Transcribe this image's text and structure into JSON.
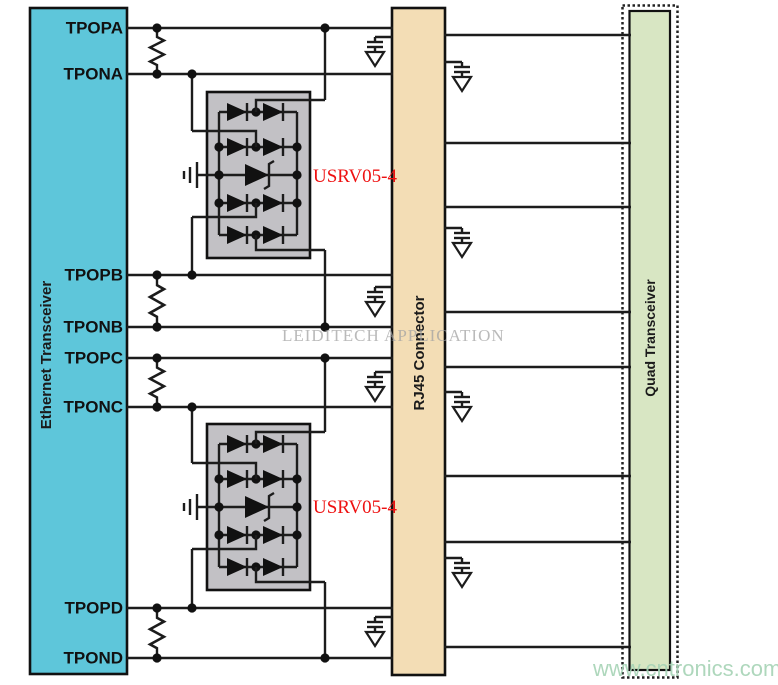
{
  "ethernet": {
    "title": "Ethernet Transceiver",
    "pins": [
      "TPOPA",
      "TPONA",
      "TPOPB",
      "TPONB",
      "TPOPC",
      "TPONC",
      "TPOPD",
      "TPOND"
    ]
  },
  "rj45": {
    "title": "RJ45 Connector"
  },
  "quad": {
    "title": "Quad Transceiver"
  },
  "tvs": {
    "label1": "USRV05-4",
    "label2": "USRV05-4"
  },
  "watermark": {
    "center": "LEIDITECH APPLICATION",
    "bottom": "www.cntronics.com"
  },
  "colors": {
    "ethernet_fill": "#5ec6da",
    "rj45_fill": "#f3ddb5",
    "quad_fill": "#d8e6c3",
    "tvs_fill": "#c2c1c5",
    "tvs_label": "#ee1111",
    "watermark_center": "#a3a3a3",
    "watermark_bottom": "#a6d3b5"
  }
}
